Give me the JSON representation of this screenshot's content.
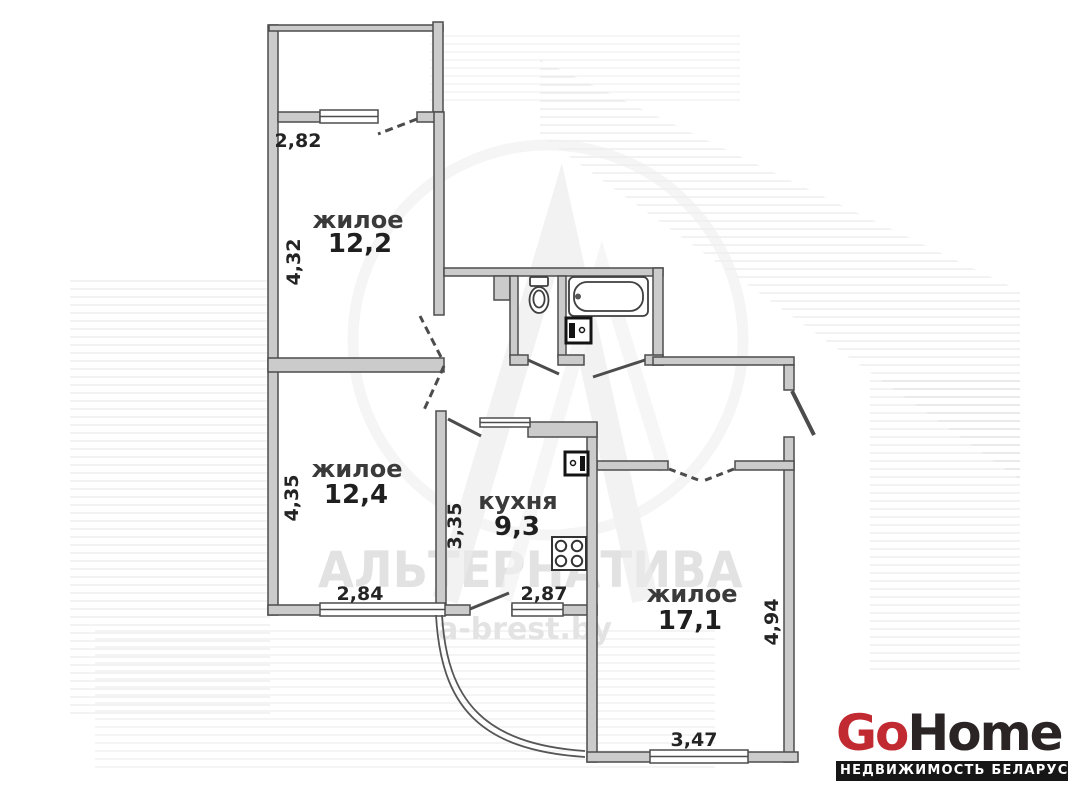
{
  "plan": {
    "rooms": {
      "room1": {
        "name": "жилое",
        "area": "12,2"
      },
      "room2": {
        "name": "жилое",
        "area": "12,4"
      },
      "kitchen": {
        "name": "кухня",
        "area": "9,3"
      },
      "room3": {
        "name": "жилое",
        "area": "17,1"
      }
    },
    "dimensions": {
      "balcony_width": "2,82",
      "room1_depth": "4,32",
      "room2_depth": "4,35",
      "room2_width": "2,84",
      "kitchen_depth": "3,35",
      "kitchen_width": "2,87",
      "room3_depth": "4,94",
      "room3_width": "3,47"
    },
    "colors": {
      "wall_fill": "#cbcbcb",
      "wall_outline": "#4d4d4d"
    }
  },
  "watermark": {
    "agency": "АЛЬТЕРНАТИВА",
    "website": "a-brest.by"
  },
  "logo": {
    "go": "Go",
    "home": "Home",
    "tagline": "НЕДВИЖИМОСТЬ БЕЛАРУСИ",
    "colors": {
      "red": "#c22a31",
      "dark": "#2a2425",
      "bar_bg": "#161616"
    }
  }
}
